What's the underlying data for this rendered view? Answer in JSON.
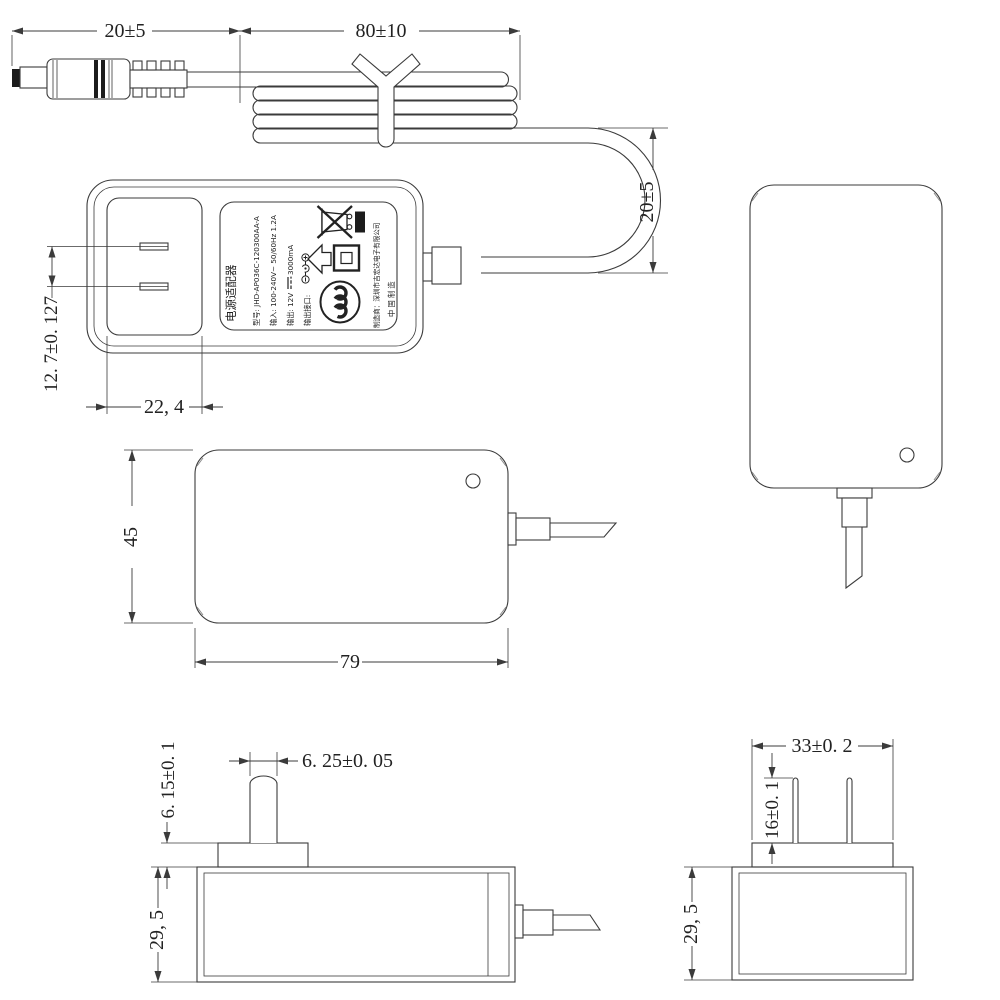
{
  "page": {
    "background": "#ffffff",
    "line_color": "#3b3b3b"
  },
  "dimensions": {
    "plug_length": "20±5",
    "coil_length": "80±10",
    "loop_height": "20±5",
    "pin_pitch": "12. 7±0. 127",
    "plug_face_width": "22, 4",
    "body_height": "45",
    "body_length": "79",
    "blade_width": "6. 25±0. 05",
    "boss_height": "6. 15±0. 1",
    "body_thickness_side": "29, 5",
    "boss_width": "33±0. 2",
    "blade_length": "16±0. 1",
    "body_thickness_end": "29, 5"
  },
  "label": {
    "product_name": "电源适配器",
    "model": "型号: JHD-AP036C-120300AA-A",
    "input": "输入: 100-240V~ 50/60Hz 1.2A",
    "output_prefix": "输出: 12V",
    "output_suffix": "3000mA",
    "output_port": "输出接口:",
    "manufacturer": "制造商：深圳市吉宏达电子有限公司",
    "made_in": "中 国 制 造",
    "icons": {
      "weee": "weee-crossed-bin-icon",
      "weee_bar": "solid-bar-icon",
      "indoor": "hollow-arrow-icon",
      "class2": "class-ii-double-square-icon",
      "ccc": "ccc-certification-icon",
      "polarity": "dc-polarity-icon"
    }
  }
}
